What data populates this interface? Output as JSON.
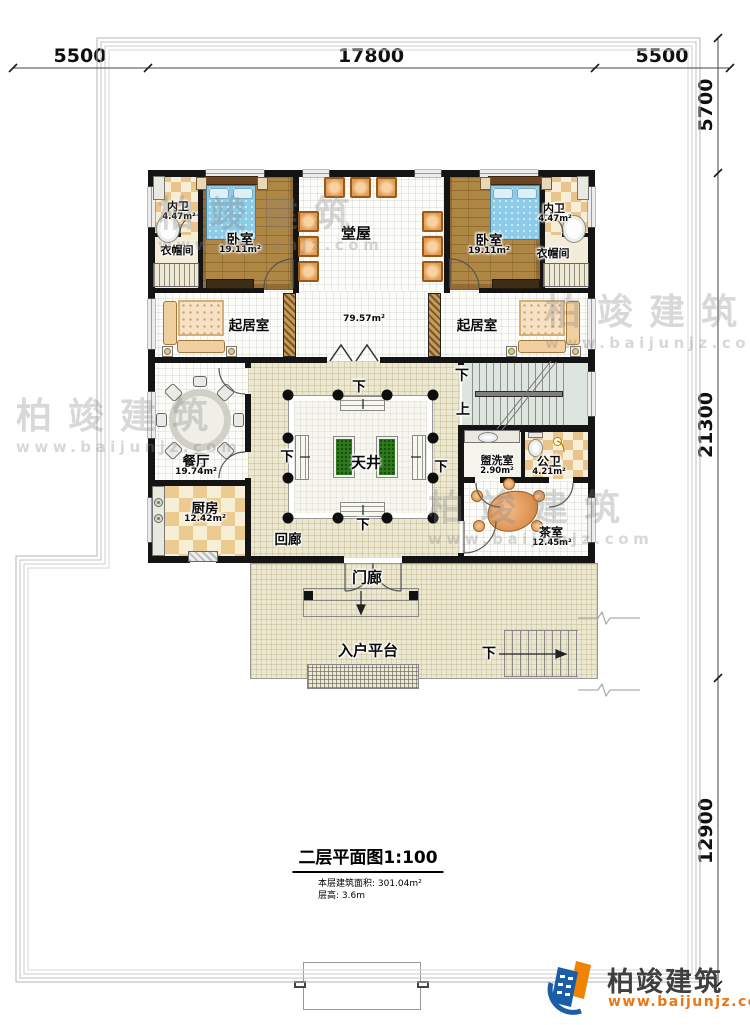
{
  "dimensions": {
    "top": [
      "5500",
      "17800",
      "5500"
    ],
    "right": [
      "5700",
      "21300",
      "12900"
    ]
  },
  "rooms": {
    "bath_left": {
      "name": "内卫",
      "area": "4.47m²"
    },
    "closet_left": {
      "name": "衣帽间"
    },
    "bedroom_left": {
      "name": "卧室",
      "area": "19.11m²"
    },
    "hall": {
      "name": "堂屋"
    },
    "hall_area": "79.57m²",
    "bedroom_right": {
      "name": "卧室",
      "area": "19.11m²"
    },
    "bath_right": {
      "name": "内卫",
      "area": "4.47m²"
    },
    "closet_right": {
      "name": "衣帽间"
    },
    "living_left": {
      "name": "起居室"
    },
    "living_right": {
      "name": "起居室"
    },
    "dining": {
      "name": "餐厅",
      "area": "19.74m²"
    },
    "kitchen": {
      "name": "厨房",
      "area": "12.42m²"
    },
    "cloister": {
      "name": "回廊"
    },
    "courtyard": {
      "name": "天井"
    },
    "washroom": {
      "name": "盥洗室",
      "area": "2.90m²"
    },
    "toilet": {
      "name": "公卫",
      "area": "4.21m²"
    },
    "tearoom": {
      "name": "茶室",
      "area": "12.45m²"
    },
    "porch": {
      "name": "门廊"
    },
    "platform": {
      "name": "入户平台"
    }
  },
  "stairs": {
    "down": "下",
    "up": "上"
  },
  "titleblock": {
    "title": "二层平面图1:100",
    "area_line": "本层建筑面积: 301.04m²",
    "height_line": "层高: 3.6m"
  },
  "logo": {
    "name": "柏竣建筑",
    "url": "www.baijunjz.com"
  },
  "watermark": {
    "name": "柏竣建筑",
    "url": "www.baijunjz.com"
  },
  "colors": {
    "wall": "#141414",
    "wood": "#af8745",
    "beige": "#ece7cf",
    "planter": "#2e7a1d",
    "logo_blue": "#1b5ea6",
    "logo_orange": "#f08300",
    "accent": "#e87818"
  }
}
